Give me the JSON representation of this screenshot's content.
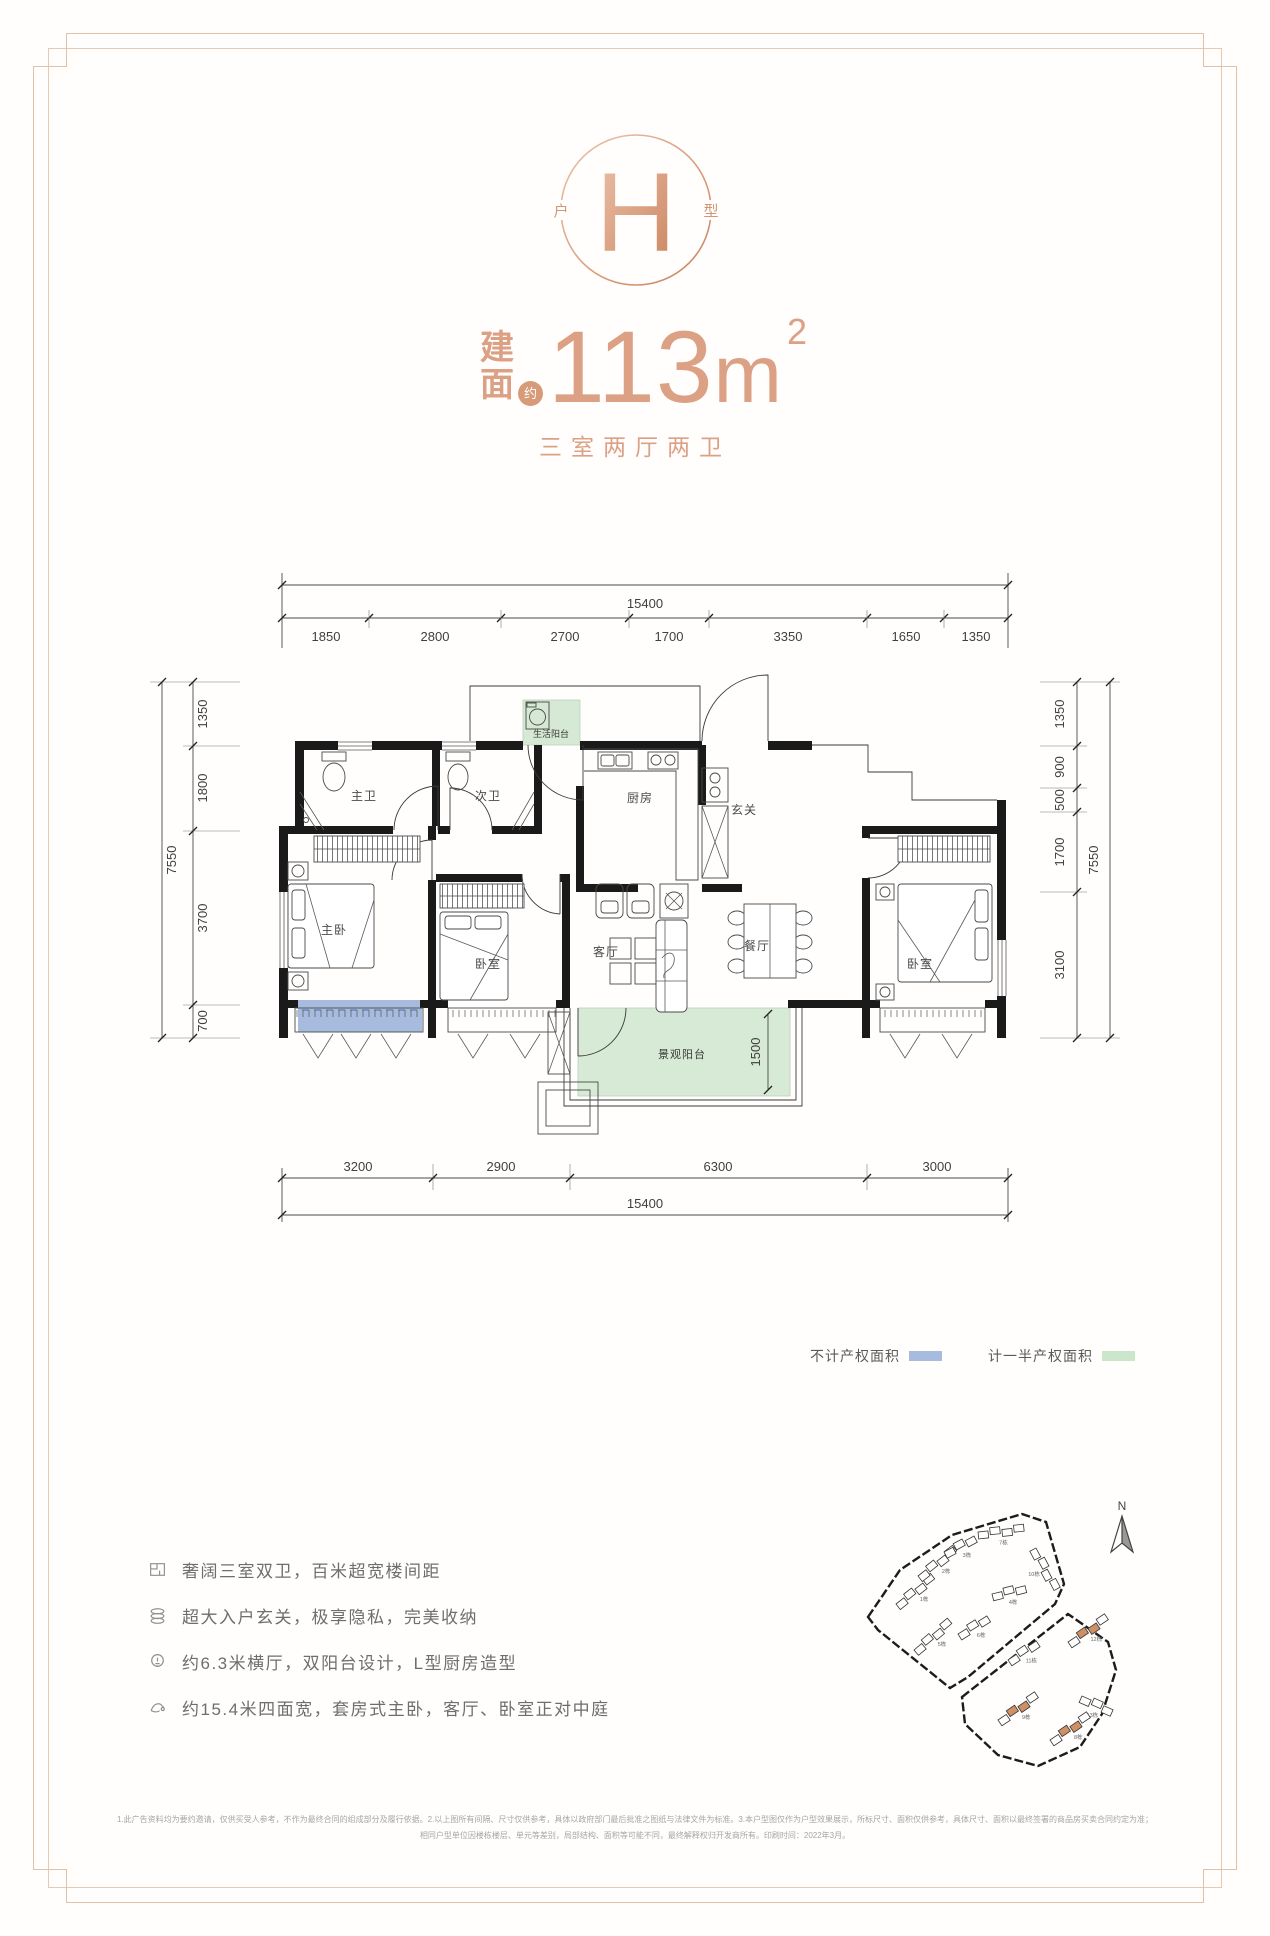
{
  "accent_color": "#DCA084",
  "legend_blue": "#A7BBDE",
  "legend_green": "#D5E8D2",
  "logo": {
    "letter": "H",
    "side_left": "户",
    "side_right": "型"
  },
  "headline": {
    "label_char1": "建",
    "label_char2": "面",
    "approx": "约",
    "area_value": "113",
    "area_unit": "m",
    "area_sup": "2",
    "subtitle": "三室两厅两卫"
  },
  "floorplan": {
    "dims_top_total": "15400",
    "dims_top": [
      "1850",
      "2800",
      "2700",
      "1700",
      "3350",
      "1650",
      "1350"
    ],
    "dims_bottom": [
      "3200",
      "2900",
      "6300",
      "3000"
    ],
    "dims_bottom_total": "15400",
    "dims_left_total": "7550",
    "dims_left": [
      "1350",
      "1800",
      "3700",
      "700"
    ],
    "dims_right": [
      "1350",
      "900",
      "500",
      "1700",
      "3100"
    ],
    "dims_right_total": "7550",
    "balcony_depth": "1500",
    "rooms": {
      "master_bath": "主卫",
      "second_bath": "次卫",
      "kitchen": "厨房",
      "foyer": "玄关",
      "service_balcony": "生活阳台",
      "master_bedroom": "主卧",
      "bedroom2": "卧室",
      "living": "客厅",
      "dining": "餐厅",
      "bedroom3": "卧室",
      "view_balcony": "景观阳台"
    }
  },
  "legend": {
    "no_property": {
      "label": "不计产权面积",
      "color": "#A7BBDE"
    },
    "half_property": {
      "label": "计一半产权面积",
      "color": "#CBE6CA"
    }
  },
  "features": [
    {
      "icon": "plan-icon",
      "text": "奢阔三室双卫，百米超宽楼间距"
    },
    {
      "icon": "storage-icon",
      "text": "超大入户玄关，极享隐私，完美收纳"
    },
    {
      "icon": "bulb-icon",
      "text": "约6.3米横厅，双阳台设计，L型厨房造型"
    },
    {
      "icon": "hand-icon",
      "text": "约15.4米四面宽，套房式主卧，客厅、卧室正对中庭"
    }
  ],
  "sitemap": {
    "north": "N",
    "buildings": [
      {
        "label": "1栋",
        "x": 46,
        "y": 112,
        "rot": -38,
        "n": 4,
        "hl": false
      },
      {
        "label": "2栋",
        "x": 68,
        "y": 84,
        "rot": -38,
        "n": 4,
        "hl": false
      },
      {
        "label": "3栋",
        "x": 94,
        "y": 60,
        "rot": -28,
        "n": 3,
        "hl": false
      },
      {
        "label": "7栋",
        "x": 128,
        "y": 40,
        "rot": -6,
        "n": 4,
        "hl": false
      },
      {
        "label": "10栋",
        "x": 186,
        "y": 56,
        "rot": 62,
        "n": 4,
        "hl": false
      },
      {
        "label": "4栋",
        "x": 142,
        "y": 102,
        "rot": -14,
        "n": 3,
        "hl": false
      },
      {
        "label": "6栋",
        "x": 108,
        "y": 142,
        "rot": -32,
        "n": 3,
        "hl": false
      },
      {
        "label": "5栋",
        "x": 64,
        "y": 158,
        "rot": -40,
        "n": 4,
        "hl": false
      },
      {
        "label": "11栋",
        "x": 158,
        "y": 168,
        "rot": -34,
        "n": 3,
        "hl": false
      },
      {
        "label": "12栋",
        "x": 218,
        "y": 150,
        "rot": -34,
        "n": 4,
        "hl": true
      },
      {
        "label": "13栋",
        "x": 232,
        "y": 204,
        "rot": 24,
        "n": 3,
        "hl": false
      },
      {
        "label": "9栋",
        "x": 148,
        "y": 228,
        "rot": -34,
        "n": 4,
        "hl": true
      },
      {
        "label": "8栋",
        "x": 200,
        "y": 248,
        "rot": -34,
        "n": 4,
        "hl": true
      }
    ]
  },
  "disclaimer": {
    "line1": "1.此广告资料均为要约邀请，仅供买受人参考，不作为最终合同的组成部分及履行依据。2.以上图所有间隔、尺寸仅供参考，具体以政府部门最后批准之图纸与法律文件为标准。3.本户型图仅作为户型效果展示，所标尺寸、面积仅供参考，具体尺寸、面积以最终签署的商品房买卖合同约定为准；",
    "line2": "相同户型单位因楼栋楼层、单元等差别，局部结构、面积等可能不同，最终解释权归开发商所有。印刷时间：2022年3月。"
  }
}
